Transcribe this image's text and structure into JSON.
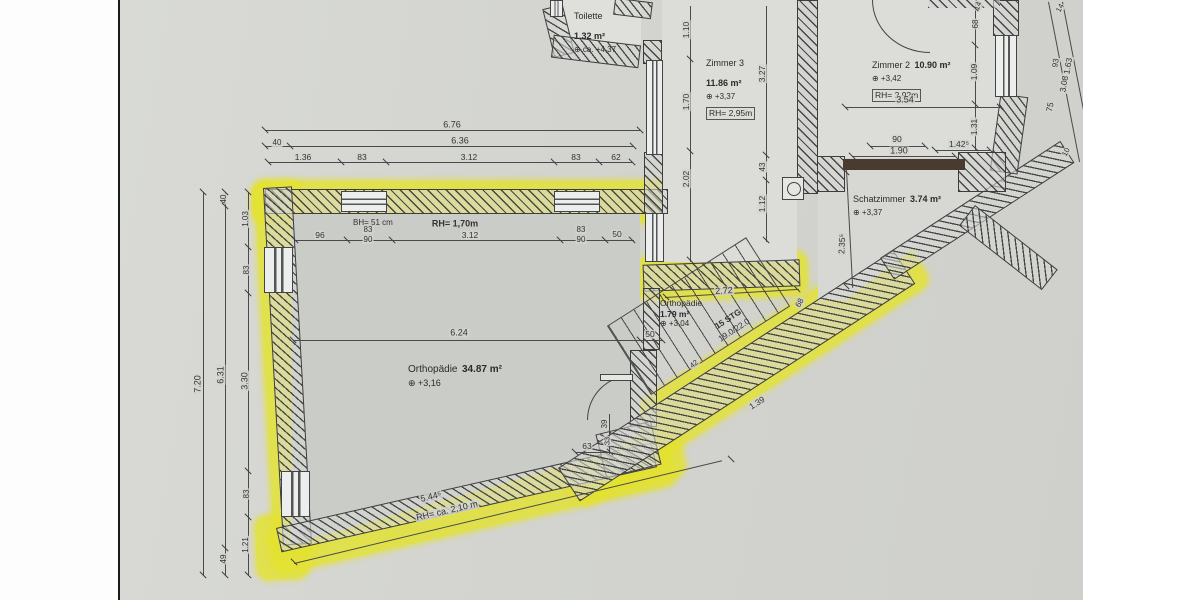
{
  "drawing": {
    "kind_label": "floor plan (scanned)",
    "colors": {
      "highlight": "#e3e230",
      "page": "#d3d4d0",
      "line": "#4a4a4a",
      "threshold": "#4a3b31"
    }
  },
  "rooms": {
    "toilette": {
      "name": "Toilette",
      "area": "1.32 m²",
      "level": "⊕ ca. +4,37"
    },
    "zimmer3": {
      "name": "Zimmer 3",
      "area": "11.86 m²",
      "level": "⊕ +3,37",
      "rh": "RH= 2,95m"
    },
    "zimmer2": {
      "name": "Zimmer 2",
      "area": "10.90 m²",
      "level": "⊕ +3,42",
      "rh": "RH= 2,92m"
    },
    "schatzimmer": {
      "name": "Schatzimmer",
      "area": "3.74 m²",
      "level": "⊕ +3,37"
    },
    "orthopaedie_main": {
      "name": "Orthopädie",
      "area": "34.87 m²",
      "level": "⊕ +3,16",
      "parapet": "BH= 51 cm",
      "rh_window": "RH= 1,70m",
      "rh_low": "RH= ca. 2,10 m"
    },
    "orthopaedie_stair": {
      "name": "Orthopädie",
      "area": "1.79 m²",
      "level": "⊕ +3,04"
    }
  },
  "stairs": {
    "label_line1": "15 STG",
    "label_line2": "19.0/22.0"
  },
  "dimensions": [
    {
      "t": "6.76",
      "x": 452,
      "y": 125,
      "r": 0,
      "fs": 9
    },
    {
      "t": "40",
      "x": 277,
      "y": 143,
      "r": 0,
      "fs": 8
    },
    {
      "t": "6.36",
      "x": 460,
      "y": 141,
      "r": 0,
      "fs": 9
    },
    {
      "t": "1.36",
      "x": 303,
      "y": 157,
      "r": 0,
      "fs": 8.5
    },
    {
      "t": "83",
      "x": 362,
      "y": 157,
      "r": 0,
      "fs": 8.5
    },
    {
      "t": "3.12",
      "x": 469,
      "y": 157,
      "r": 0,
      "fs": 8.5
    },
    {
      "t": "83",
      "x": 576,
      "y": 157,
      "r": 0,
      "fs": 8.5
    },
    {
      "t": "62",
      "x": 616,
      "y": 157,
      "r": 0,
      "fs": 8.5
    },
    {
      "t": "96",
      "x": 320,
      "y": 235,
      "r": 0,
      "fs": 8.5
    },
    {
      "t": "83",
      "x": 368,
      "y": 230,
      "r": 0,
      "fs": 8
    },
    {
      "t": "90",
      "x": 368,
      "y": 240,
      "r": 0,
      "fs": 8
    },
    {
      "t": "3.12",
      "x": 470,
      "y": 235,
      "r": 0,
      "fs": 8.5
    },
    {
      "t": "83",
      "x": 581,
      "y": 230,
      "r": 0,
      "fs": 8
    },
    {
      "t": "90",
      "x": 581,
      "y": 240,
      "r": 0,
      "fs": 8
    },
    {
      "t": "50",
      "x": 617,
      "y": 234,
      "r": 0,
      "fs": 8.5
    },
    {
      "t": "6.24",
      "x": 459,
      "y": 333,
      "r": 0,
      "fs": 9
    },
    {
      "t": "50",
      "x": 650,
      "y": 334,
      "r": 0,
      "fs": 8.5
    },
    {
      "t": "63",
      "x": 587,
      "y": 446,
      "r": 0,
      "fs": 8.5
    },
    {
      "t": "39",
      "x": 605,
      "y": 424,
      "r": -90,
      "fs": 8
    },
    {
      "t": "33",
      "x": 607,
      "y": 441,
      "r": -90,
      "fs": 7.5
    },
    {
      "t": "7.20",
      "x": 198,
      "y": 384,
      "r": -90,
      "fs": 9
    },
    {
      "t": "40",
      "x": 224,
      "y": 199,
      "r": -90,
      "fs": 8
    },
    {
      "t": "6.31",
      "x": 221,
      "y": 375,
      "r": -90,
      "fs": 9
    },
    {
      "t": "49",
      "x": 224,
      "y": 559,
      "r": -90,
      "fs": 8
    },
    {
      "t": "1.03",
      "x": 246,
      "y": 219,
      "r": -90,
      "fs": 8
    },
    {
      "t": "83",
      "x": 247,
      "y": 270,
      "r": -90,
      "fs": 8
    },
    {
      "t": "3.30",
      "x": 245,
      "y": 381,
      "r": -90,
      "fs": 9
    },
    {
      "t": "83",
      "x": 247,
      "y": 494,
      "r": -90,
      "fs": 8
    },
    {
      "t": "1.21",
      "x": 246,
      "y": 545,
      "r": -90,
      "fs": 8
    },
    {
      "t": "1.10",
      "x": 686,
      "y": 30,
      "r": -90,
      "fs": 8.5
    },
    {
      "t": "1.70",
      "x": 686,
      "y": 102,
      "r": -90,
      "fs": 8.5
    },
    {
      "t": "2.02",
      "x": 686,
      "y": 179,
      "r": -90,
      "fs": 8.5
    },
    {
      "t": "3.27",
      "x": 762,
      "y": 74,
      "r": -90,
      "fs": 8.5
    },
    {
      "t": "43",
      "x": 763,
      "y": 167,
      "r": -90,
      "fs": 8
    },
    {
      "t": "1.12",
      "x": 762,
      "y": 204,
      "r": -90,
      "fs": 8.5
    },
    {
      "t": "3.54",
      "x": 905,
      "y": 100,
      "r": 0,
      "fs": 9
    },
    {
      "t": "14",
      "x": 978,
      "y": 6,
      "r": -70,
      "fs": 7.5
    },
    {
      "t": "68",
      "x": 976,
      "y": 24,
      "r": -90,
      "fs": 8
    },
    {
      "t": "1.09",
      "x": 974,
      "y": 72,
      "r": -90,
      "fs": 8.5
    },
    {
      "t": "1.31",
      "x": 974,
      "y": 127,
      "r": -90,
      "fs": 8.5
    },
    {
      "t": "90",
      "x": 897,
      "y": 139,
      "r": 0,
      "fs": 8.5
    },
    {
      "t": "1.90",
      "x": 899,
      "y": 151,
      "r": 0,
      "fs": 9
    },
    {
      "t": "1.42⁵",
      "x": 959,
      "y": 144,
      "r": 0,
      "fs": 8.5
    },
    {
      "t": "14",
      "x": 1060,
      "y": 8,
      "r": -62,
      "fs": 7.5
    },
    {
      "t": "93",
      "x": 1056,
      "y": 63,
      "r": -80,
      "fs": 8
    },
    {
      "t": "1.63",
      "x": 1068,
      "y": 66,
      "r": -80,
      "fs": 8.5
    },
    {
      "t": "3.08",
      "x": 1064,
      "y": 84,
      "r": -80,
      "fs": 8.5
    },
    {
      "t": "75",
      "x": 1050,
      "y": 107,
      "r": -80,
      "fs": 8.5
    },
    {
      "t": "10",
      "x": 1066,
      "y": 152,
      "r": -62,
      "fs": 7.5
    },
    {
      "t": "2.35⁵",
      "x": 842,
      "y": 244,
      "r": -87,
      "fs": 8.5
    },
    {
      "t": "2.72",
      "x": 724,
      "y": 291,
      "r": -3,
      "fs": 9
    },
    {
      "t": "68",
      "x": 800,
      "y": 303,
      "r": -62,
      "fs": 8
    },
    {
      "t": "1.39",
      "x": 757,
      "y": 403,
      "r": -33,
      "fs": 8.5
    },
    {
      "t": "42",
      "x": 694,
      "y": 364,
      "r": -40,
      "fs": 7.5
    },
    {
      "t": "5.44⁵",
      "x": 431,
      "y": 497,
      "r": -13,
      "fs": 9
    }
  ],
  "ticks": [
    [
      265,
      130
    ],
    [
      640,
      130
    ],
    [
      265,
      146
    ],
    [
      290,
      146
    ],
    [
      633,
      146
    ],
    [
      268,
      162
    ],
    [
      341,
      162
    ],
    [
      386,
      162
    ],
    [
      554,
      162
    ],
    [
      599,
      162
    ],
    [
      632,
      162
    ],
    [
      295,
      240
    ],
    [
      347,
      240
    ],
    [
      392,
      240
    ],
    [
      560,
      240
    ],
    [
      605,
      240
    ],
    [
      632,
      240
    ],
    [
      293,
      340
    ],
    [
      640,
      340
    ],
    [
      662,
      340
    ],
    [
      575,
      452
    ],
    [
      610,
      452
    ],
    [
      203,
      192
    ],
    [
      203,
      575
    ],
    [
      225,
      192
    ],
    [
      225,
      206
    ],
    [
      225,
      548
    ],
    [
      225,
      575
    ],
    [
      248,
      192
    ],
    [
      248,
      247
    ],
    [
      248,
      293
    ],
    [
      248,
      471
    ],
    [
      248,
      517
    ],
    [
      248,
      575
    ],
    [
      690,
      59
    ],
    [
      690,
      151
    ],
    [
      690,
      260
    ],
    [
      766,
      155
    ],
    [
      766,
      180
    ],
    [
      766,
      240
    ],
    [
      975,
      8
    ],
    [
      975,
      45
    ],
    [
      975,
      104
    ],
    [
      975,
      148
    ],
    [
      845,
      107
    ],
    [
      1000,
      107
    ],
    [
      870,
      146
    ],
    [
      925,
      146
    ],
    [
      852,
      156
    ],
    [
      955,
      156
    ],
    [
      935,
      150
    ],
    [
      990,
      150
    ],
    [
      294,
      562
    ],
    [
      731,
      459
    ],
    [
      666,
      297
    ],
    [
      797,
      289
    ],
    [
      846,
      172
    ],
    [
      846,
      286
    ]
  ]
}
